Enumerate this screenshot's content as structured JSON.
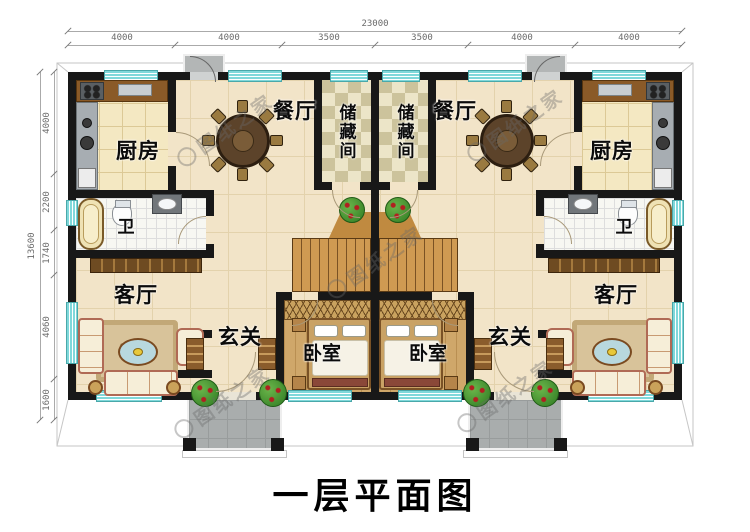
{
  "title": "一层平面图",
  "watermark": {
    "text": "图纸之家"
  },
  "dims": {
    "top": {
      "total": "23000",
      "segments": [
        "4000",
        "4000",
        "3500",
        "3500",
        "4000",
        "4000"
      ]
    },
    "left": {
      "total": "13600",
      "segments": [
        "4000",
        "2200",
        "1740",
        "4060",
        "1600"
      ]
    }
  },
  "rooms": {
    "kitchen": "厨房",
    "dining": "餐厅",
    "storage": "储藏间",
    "bath": "卫",
    "living": "客厅",
    "foyer": "玄关",
    "bedroom": "卧室"
  },
  "colors": {
    "wall": "#181818",
    "window": "#7fd8da",
    "floor": "#f2e4c8",
    "stairs": "#cf9a52",
    "porch": "#a9adad"
  }
}
